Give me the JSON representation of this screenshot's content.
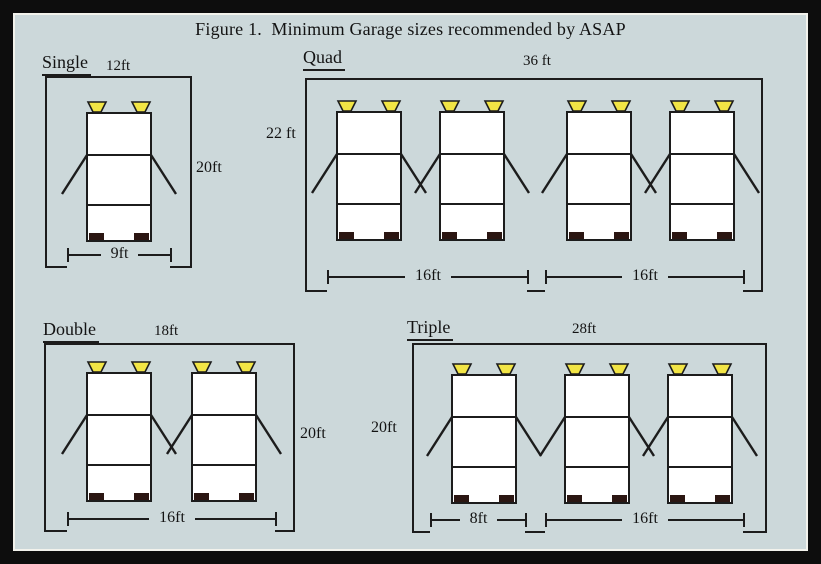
{
  "title": "Figure 1.  Minimum Garage sizes recommended by ASAP",
  "colors": {
    "background": "#ccd8da",
    "line": "#1c1c1c",
    "frame": "#0d0d0d",
    "car_body": "#ffffff",
    "headlight": "#f2e545",
    "wheel": "#2b1612"
  },
  "garages": [
    {
      "name": "Single",
      "overall_width": "12ft",
      "overall_depth": "20ft",
      "car_count": 1,
      "doors": [
        {
          "width": "9ft"
        }
      ]
    },
    {
      "name": "Quad",
      "overall_width": "36 ft",
      "overall_depth": "22 ft",
      "car_count": 4,
      "doors": [
        {
          "width": "16ft"
        },
        {
          "width": "16ft"
        }
      ]
    },
    {
      "name": "Double",
      "overall_width": "18ft",
      "overall_depth": "20ft",
      "car_count": 2,
      "doors": [
        {
          "width": "16ft"
        }
      ]
    },
    {
      "name": "Triple",
      "overall_width": "28ft",
      "overall_depth": "20ft",
      "car_count": 3,
      "doors": [
        {
          "width": "8ft"
        },
        {
          "width": "16ft"
        }
      ]
    }
  ]
}
